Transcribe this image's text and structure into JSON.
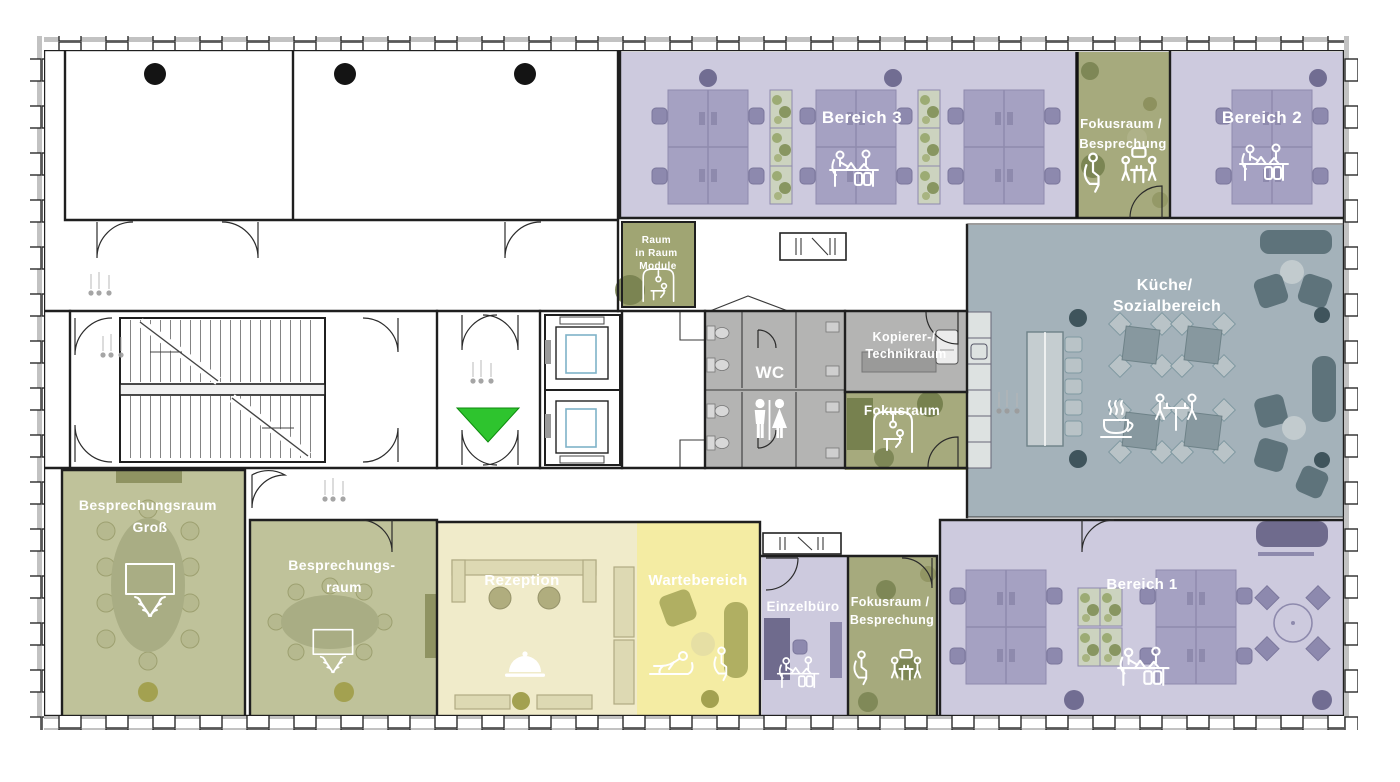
{
  "document": {
    "type": "office-floor-plan",
    "language": "de"
  },
  "palette": {
    "open_office_zone": "#cdcade",
    "meeting_room_zone": "#bfc29a",
    "focus_room_zone": "#a6aa7d",
    "kitchen_social_zone": "#a4b2ba",
    "reception_zone": "#f0ebca",
    "waiting_zone": "#f4eca3",
    "service_gray_zone": "#b4b4b3",
    "entrance_marker_green": "#2ec42e",
    "label_text": "#ffffff"
  },
  "zones": {
    "bereich_3": {
      "label_lines": [
        "Bereich 3"
      ],
      "color": "#cdcade"
    },
    "fokusraum_besprechung_oben": {
      "label_lines": [
        "Fokusraum /",
        "Besprechung"
      ],
      "color": "#a6aa7d"
    },
    "bereich_2": {
      "label_lines": [
        "Bereich 2"
      ],
      "color": "#cdcade"
    },
    "raum_in_raum_module": {
      "label_lines": [
        "Raum",
        "in Raum",
        "Module"
      ],
      "color": "#a0a573"
    },
    "kueche_sozialbereich": {
      "label_lines": [
        "Küche/",
        "Sozialbereich"
      ],
      "color": "#a4b2ba"
    },
    "kopierer_technikraum": {
      "label_lines": [
        "Kopierer-/",
        "Technikraum"
      ],
      "color": "#b4b4b3"
    },
    "wc": {
      "label_lines": [
        "WC"
      ],
      "color": "#b4b4b3"
    },
    "fokusraum": {
      "label_lines": [
        "Fokusraum"
      ],
      "color": "#a6aa7d"
    },
    "besprechungsraum_gross": {
      "label_lines": [
        "Besprechungsraum",
        "Groß"
      ],
      "color": "#bfc29a"
    },
    "besprechungsraum": {
      "label_lines": [
        "Besprechungs-",
        "raum"
      ],
      "color": "#bfc29a"
    },
    "rezeption": {
      "label_lines": [
        "Rezeption"
      ],
      "color": "#f0ebca"
    },
    "wartebereich": {
      "label_lines": [
        "Wartebereich"
      ],
      "color": "#f4eca3"
    },
    "einzelbuero": {
      "label_lines": [
        "Einzelbüro"
      ],
      "color": "#cdcade"
    },
    "fokusraum_besprechung_unten": {
      "label_lines": [
        "Fokusraum /",
        "Besprechung"
      ],
      "color": "#a6aa7d"
    },
    "bereich_1": {
      "label_lines": [
        "Bereich 1"
      ],
      "color": "#cdcade"
    }
  },
  "marker": {
    "entrance_triangle_color": "#2ec42e"
  }
}
